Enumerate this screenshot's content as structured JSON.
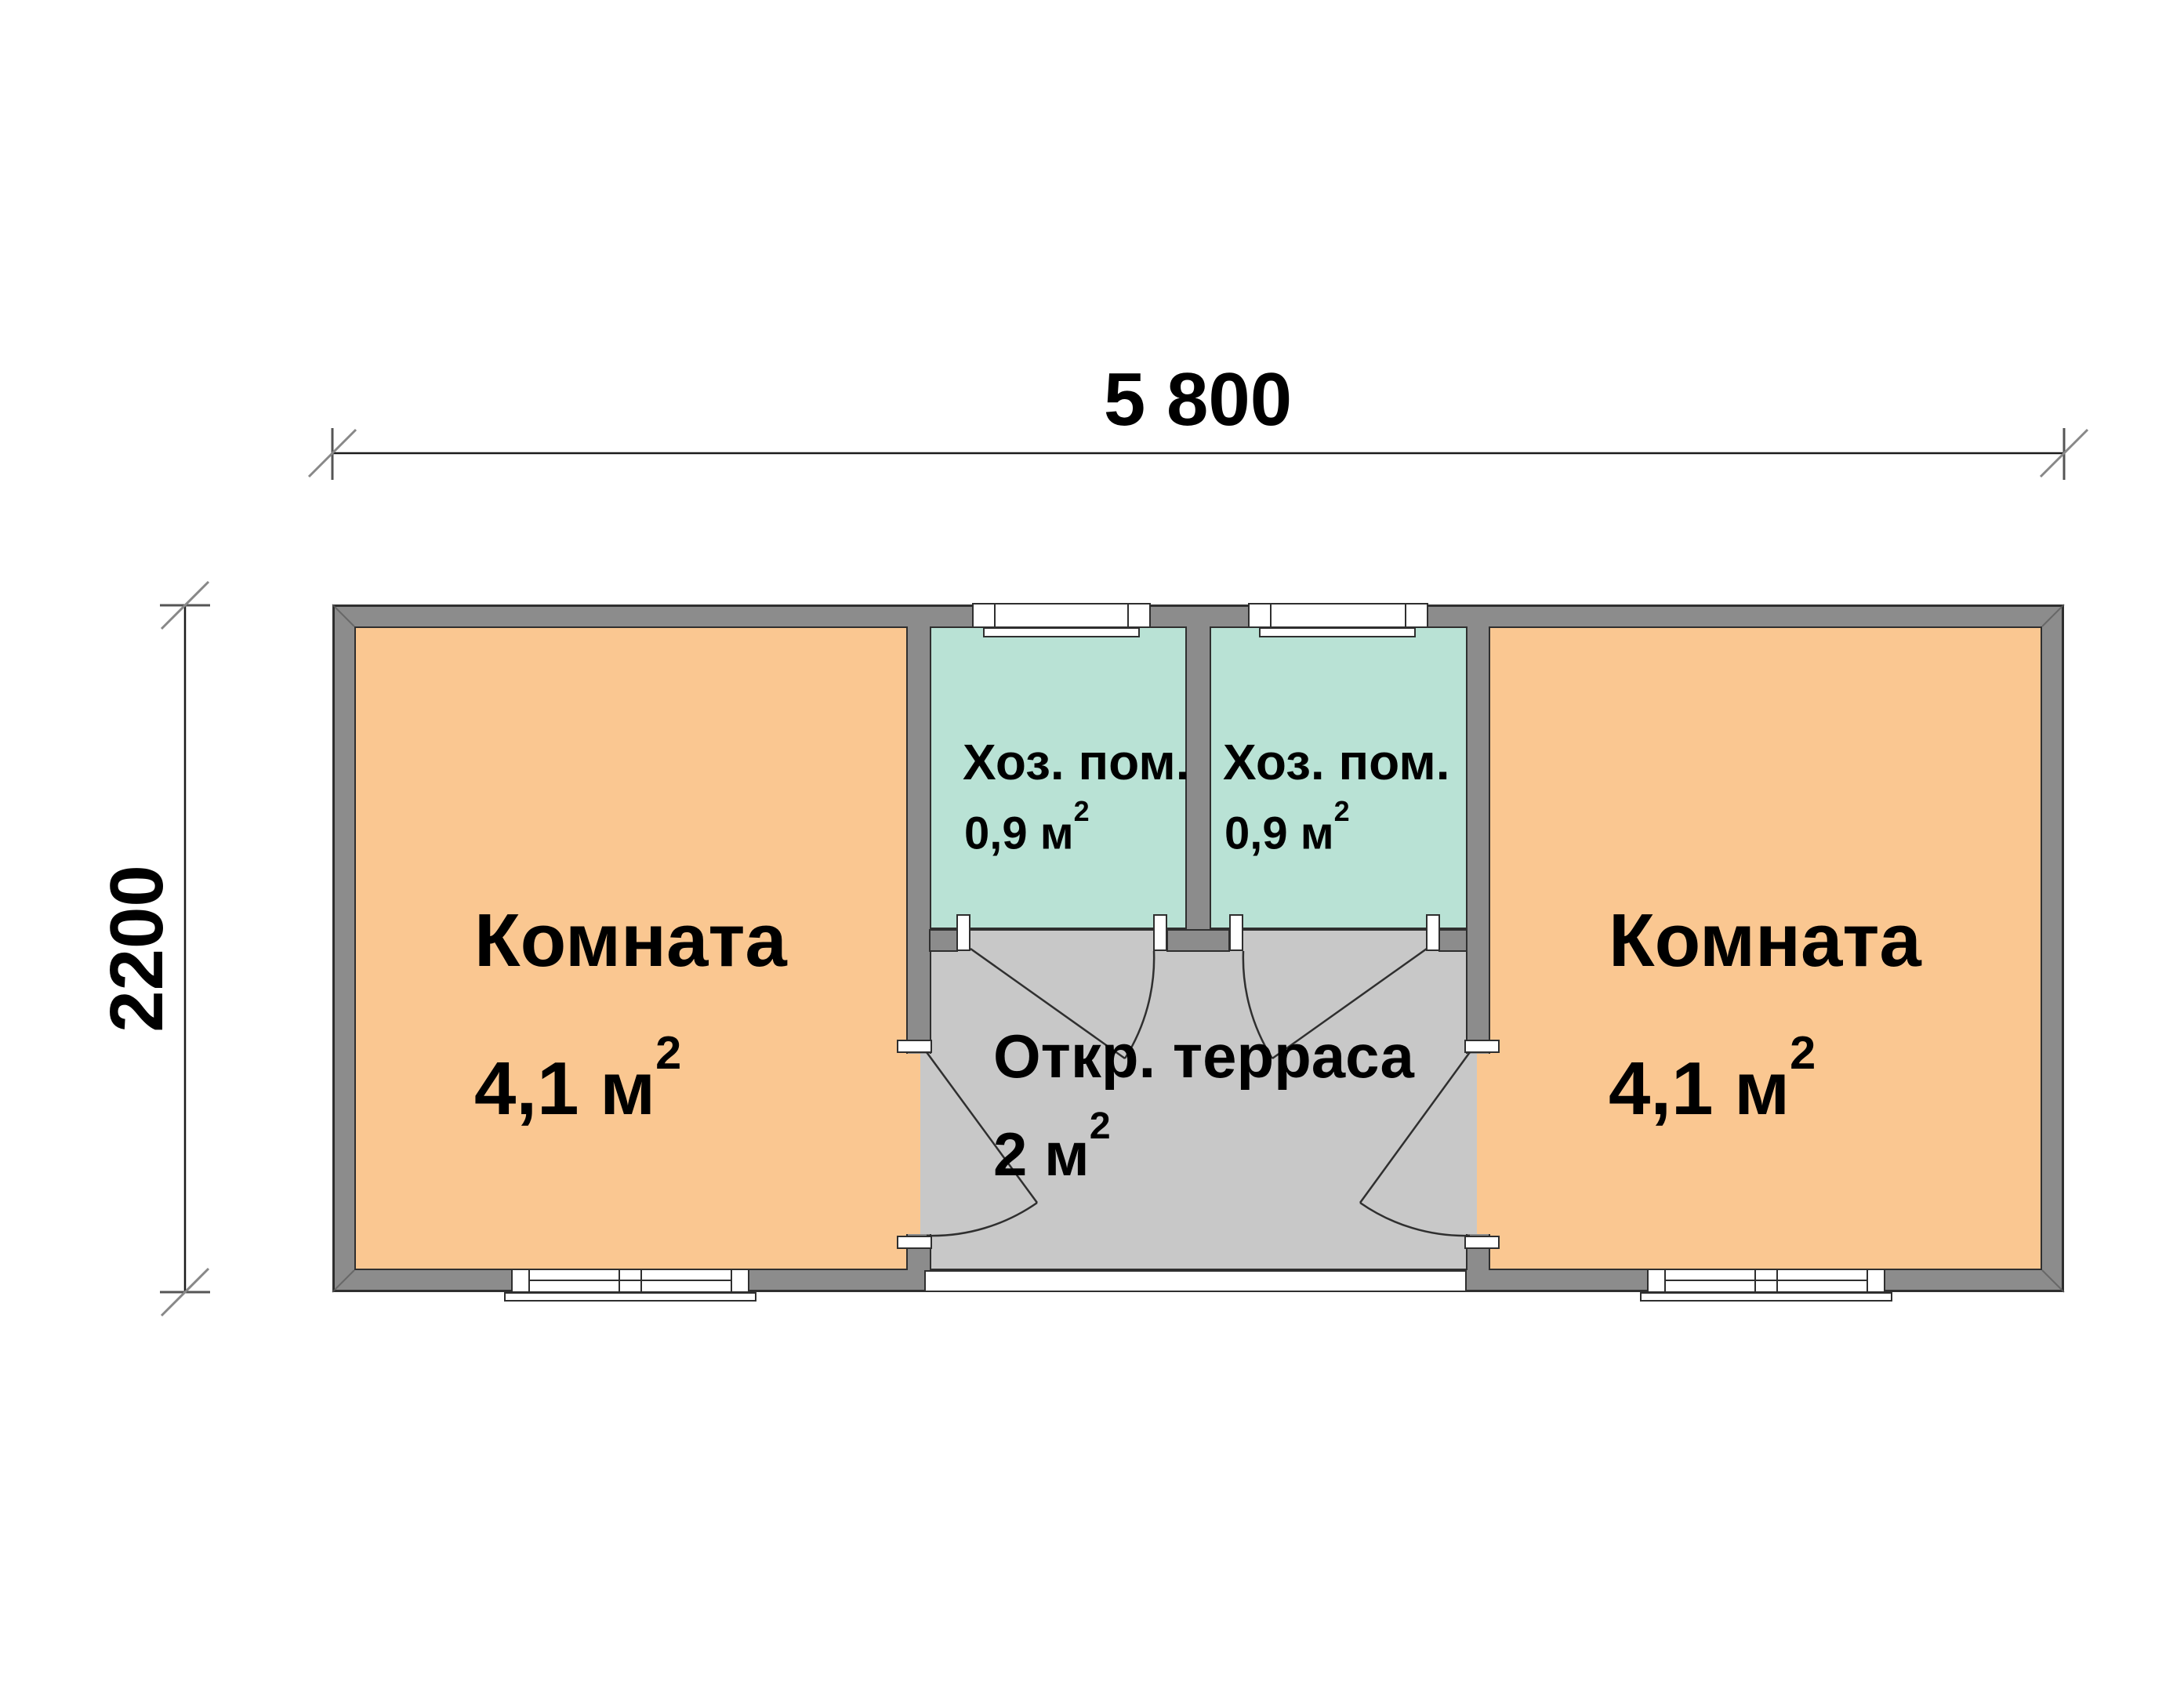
{
  "plan_title": "floor plan 5800 x 2200",
  "dimensions": {
    "width_label": "5 800",
    "height_label": "2200"
  },
  "rooms": [
    {
      "name": "Комната",
      "area": "4,1 м",
      "sup": "2"
    },
    {
      "name": "Хоз. пом.",
      "area": "0,9 м",
      "sup": "2"
    },
    {
      "name": "Хоз. пом.",
      "area": "0,9 м",
      "sup": "2"
    },
    {
      "name": "Комната",
      "area": "4,1 м",
      "sup": "2"
    },
    {
      "name": "Откр. терраса",
      "area": "2 м",
      "sup": "2"
    }
  ],
  "colors": {
    "room_fill": "#FAC791",
    "utility_fill": "#B9E2D5",
    "terrace_fill": "#C8C8C8",
    "wall_fill": "#8C8C8C",
    "outline": "#2F2F2F",
    "window_fill": "#FFFFFF",
    "dim_line": "#1A1A1A",
    "tick_gray": "#777777",
    "text_color": "#000000"
  }
}
